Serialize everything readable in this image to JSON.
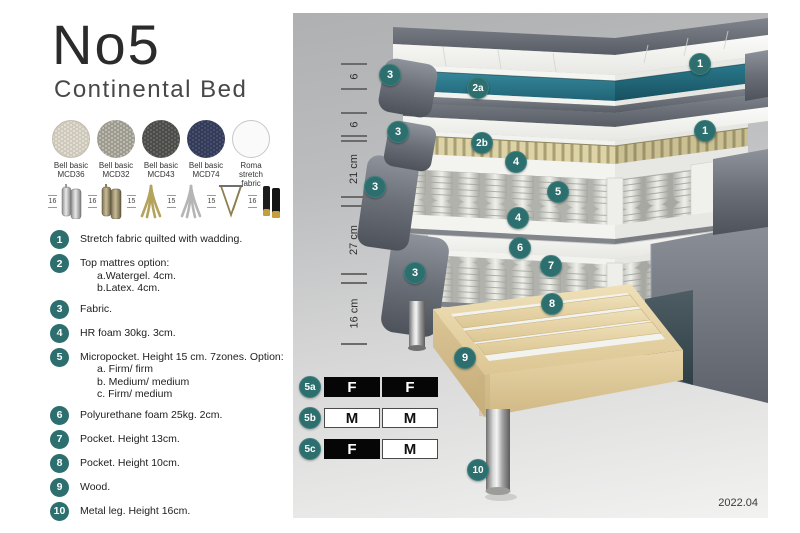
{
  "header": {
    "title": "No5",
    "subtitle": "Continental Bed"
  },
  "swatches": [
    {
      "line1": "Bell basic",
      "line2": "MCD36"
    },
    {
      "line1": "Bell basic",
      "line2": "MCD32"
    },
    {
      "line1": "Bell basic",
      "line2": "MCD43"
    },
    {
      "line1": "Bell basic",
      "line2": "MCD74"
    },
    {
      "line1": "Roma",
      "line2": "stretch fabric"
    }
  ],
  "legs": [
    {
      "size": "16",
      "type": "cylinder-silver"
    },
    {
      "size": "16",
      "type": "cylinder-bronze"
    },
    {
      "size": "15",
      "type": "splay-gold"
    },
    {
      "size": "15",
      "type": "splay-silver"
    },
    {
      "size": "15",
      "type": "hairpin-gold"
    },
    {
      "size": "16",
      "type": "cylinder-black-gold"
    }
  ],
  "features": [
    {
      "num": "1",
      "text": "Stretch fabric quilted with wadding."
    },
    {
      "num": "2",
      "text": "Top mattres option:",
      "sub": [
        "a.Watergel. 4cm.",
        "b.Latex. 4cm."
      ]
    },
    {
      "num": "3",
      "text": "Fabric."
    },
    {
      "num": "4",
      "text": "HR foam 30kg. 3cm."
    },
    {
      "num": "5",
      "text": "Micropocket. Height 15 cm. 7zones. Option:",
      "sub": [
        "a. Firm/ firm",
        "b. Medium/ medium",
        "c. Firm/ medium"
      ]
    },
    {
      "num": "6",
      "text": "Polyurethane foam 25kg. 2cm."
    },
    {
      "num": "7",
      "text": "Pocket. Height 13cm."
    },
    {
      "num": "8",
      "text": "Pocket. Height 10cm."
    },
    {
      "num": "9",
      "text": "Wood."
    },
    {
      "num": "10",
      "text": "Metal leg. Height 16cm."
    }
  ],
  "diagram": {
    "callouts": [
      "1",
      "3",
      "2a",
      "1",
      "3",
      "2b",
      "4",
      "5",
      "3",
      "4",
      "6",
      "7",
      "3",
      "8",
      "9",
      "10"
    ],
    "ruler": [
      "6",
      "6",
      "21 cm",
      "27 cm",
      "16 cm"
    ],
    "firmness": {
      "rows": [
        {
          "badge": "5a",
          "cells": [
            "F",
            "F"
          ]
        },
        {
          "badge": "5b",
          "cells": [
            "M",
            "M"
          ]
        },
        {
          "badge": "5c",
          "cells": [
            "F",
            "M"
          ]
        }
      ]
    },
    "version": "2022.04"
  },
  "colors": {
    "accent_teal": "#2C6F6E",
    "core_teal": "#2E7D8E",
    "fabric_grey": "#646A72",
    "latex_tan": "#D8CFA4",
    "wood": "#E3D2A8"
  }
}
